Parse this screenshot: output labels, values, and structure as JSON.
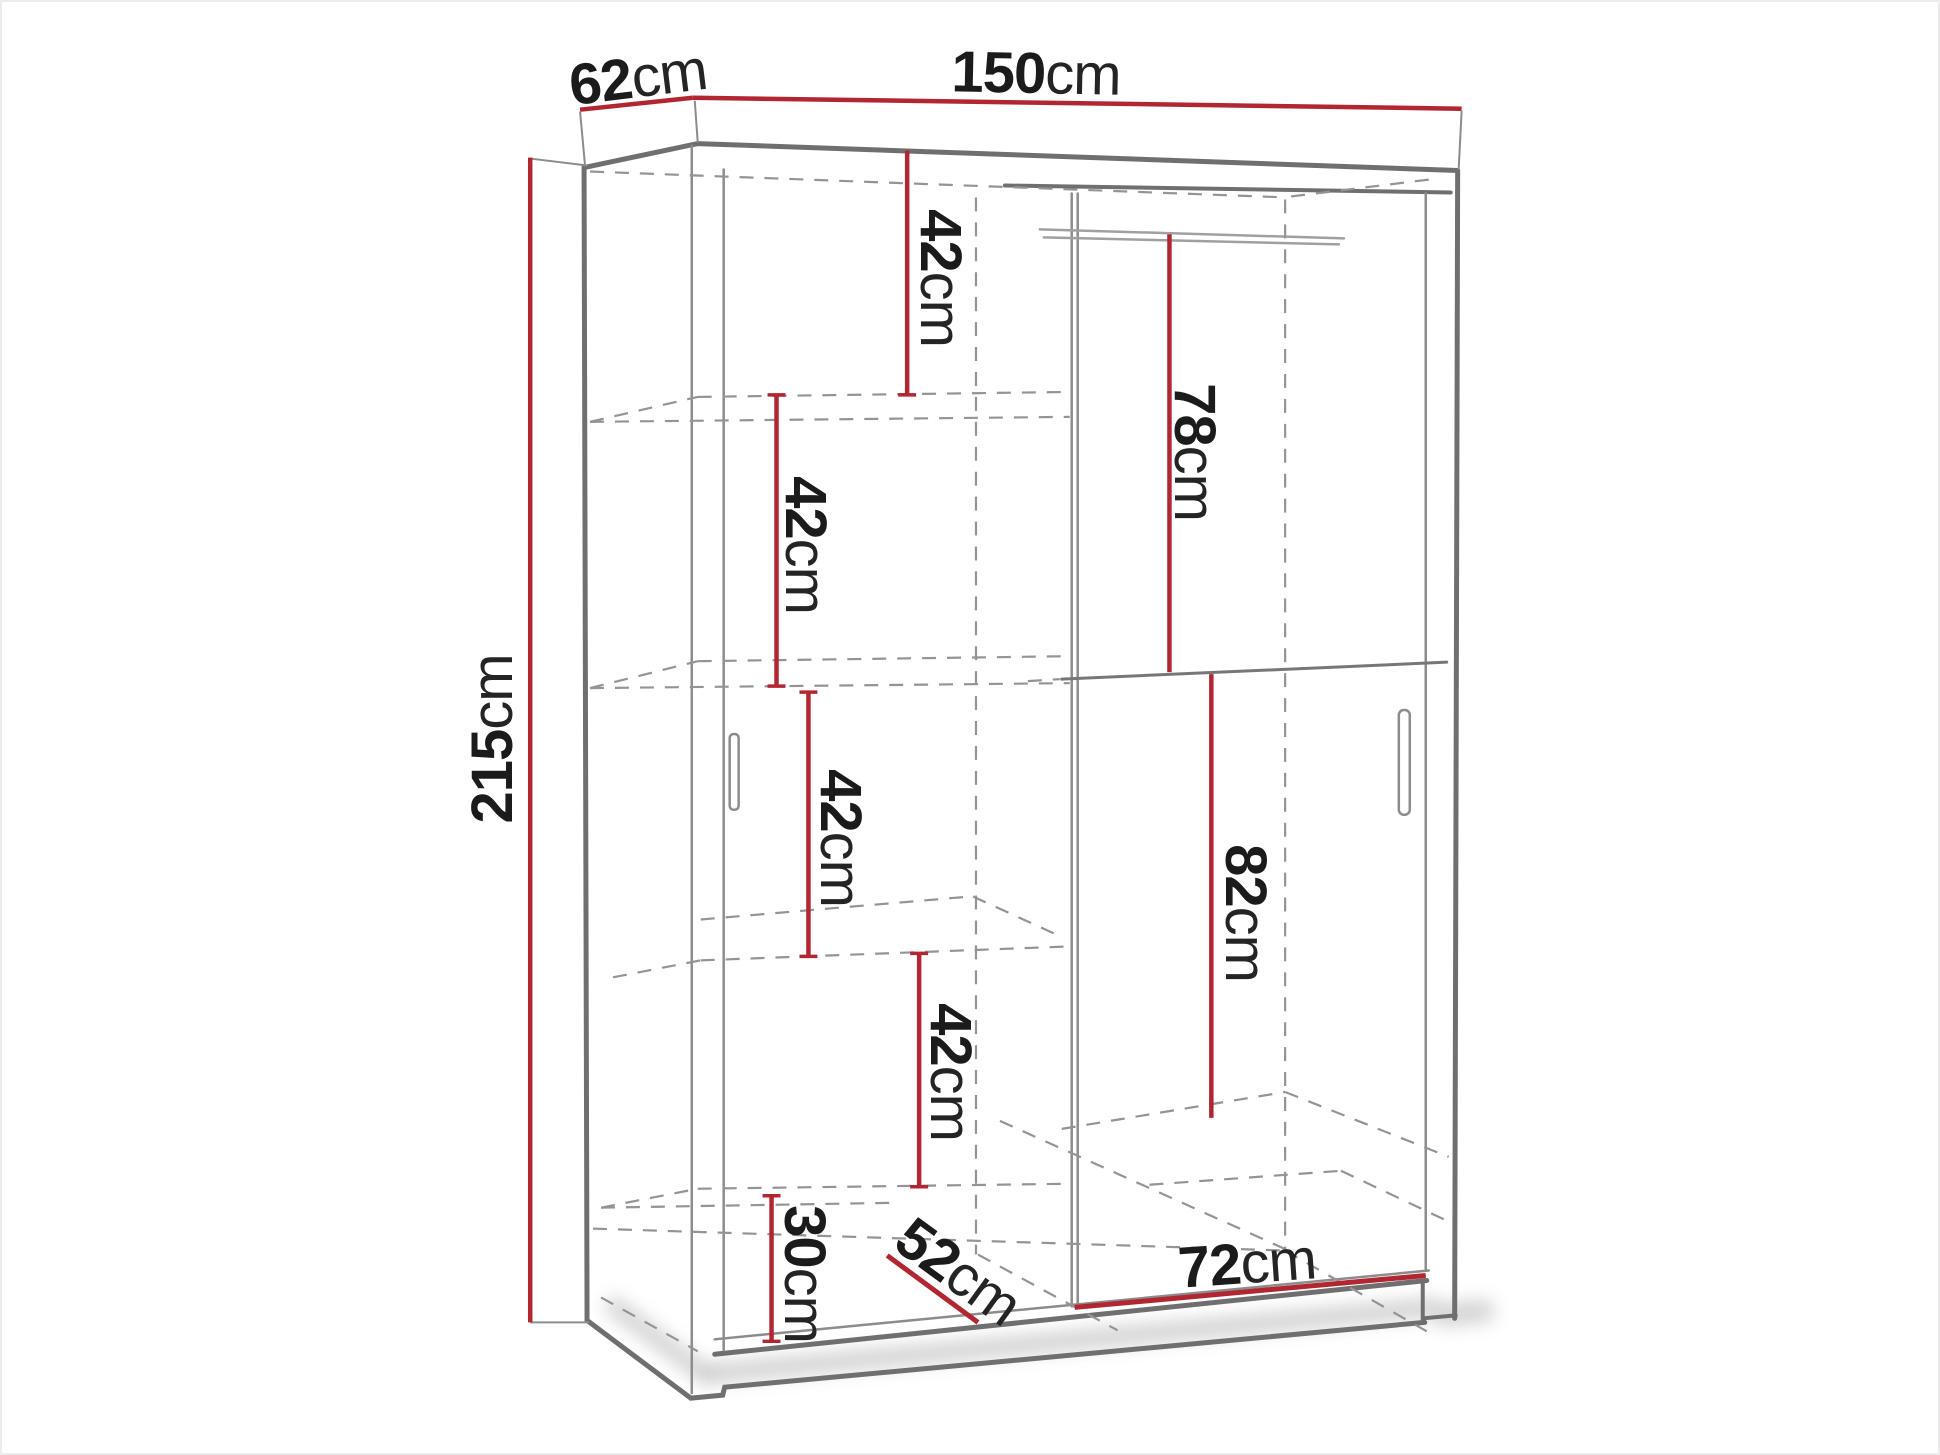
{
  "diagram": {
    "title": "Sliding wardrobe dimension drawing",
    "colors": {
      "dimension_red": "#b22631",
      "outline_gray": "#6f6f6f",
      "thin_gray": "#8c8c8c",
      "hidden_dashed_gray": "#949494",
      "label_text": "#1b1b1b",
      "background": "#ffffff"
    },
    "labels": {
      "width_top": {
        "value": "150",
        "unit": "cm"
      },
      "depth_top": {
        "value": "62",
        "unit": "cm"
      },
      "height_left": {
        "value": "215",
        "unit": "cm"
      },
      "shelf_gap_1": {
        "value": "42",
        "unit": "cm"
      },
      "shelf_gap_2": {
        "value": "42",
        "unit": "cm"
      },
      "shelf_gap_3": {
        "value": "42",
        "unit": "cm"
      },
      "shelf_gap_4": {
        "value": "42",
        "unit": "cm"
      },
      "upper_right_height": {
        "value": "78",
        "unit": "cm"
      },
      "lower_right_height": {
        "value": "82",
        "unit": "cm"
      },
      "bottom_gap": {
        "value": "30",
        "unit": "cm"
      },
      "interior_depth": {
        "value": "52",
        "unit": "cm"
      },
      "right_width": {
        "value": "72",
        "unit": "cm"
      }
    }
  }
}
